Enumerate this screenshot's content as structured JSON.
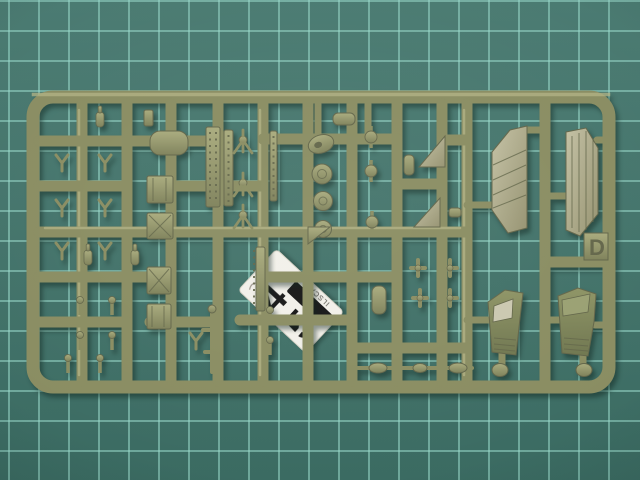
{
  "meta": {
    "description": "Photograph of an olive-drab injection-moulded model kit sprue (runner D) with many small parts, lying on a teal cutting mat with grid lines. A white sticker with large black digits sits under the runners near the centre."
  },
  "colors": {
    "mat_base": "#45756c",
    "mat_grid": "rgba(152,216,201,0.55)",
    "plastic": "#8a8d62",
    "plastic_light": "#b2b386",
    "plastic_dark": "#63664a",
    "panel_light": "#b5b294",
    "label_bg": "#f2f0e9",
    "label_ink": "#161616"
  },
  "sprue": {
    "letter_tab": "D"
  },
  "label": {
    "digit_top": "4",
    "digit_bottom": "5",
    "edge_text": "ILSCA"
  }
}
